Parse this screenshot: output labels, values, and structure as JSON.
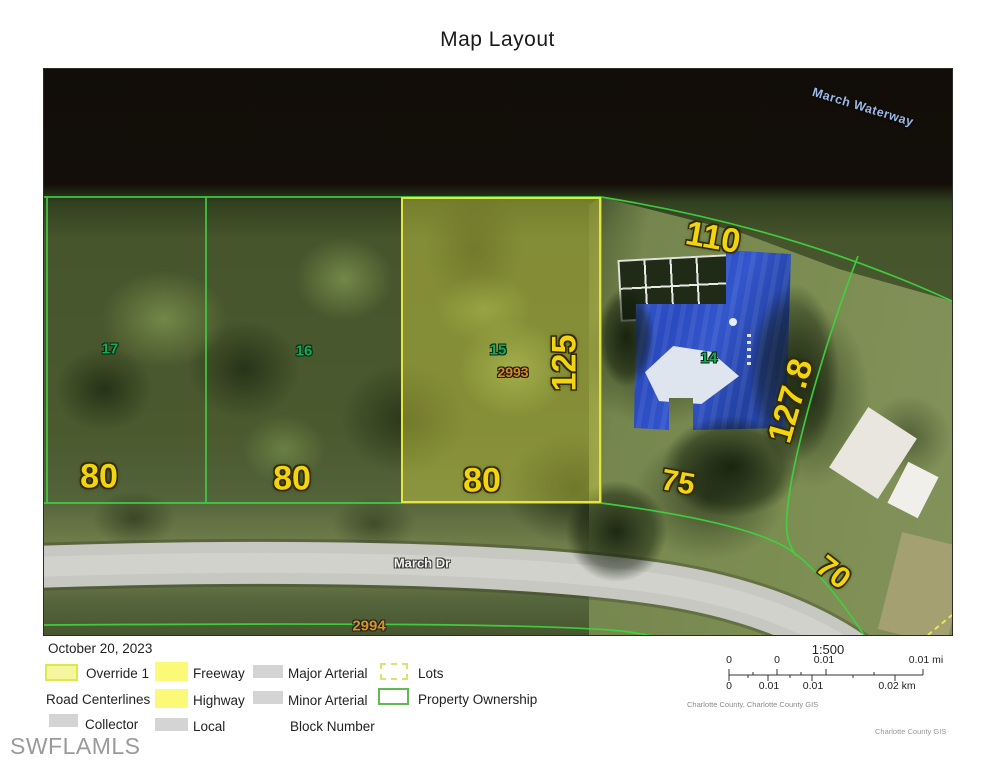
{
  "title": "Map Layout",
  "map": {
    "waterway": "March Waterway",
    "street": "March Dr",
    "lot17": "17",
    "lot16": "16",
    "lot15": "15",
    "lot14": "14",
    "parcel15_id": "2993",
    "block_line": "2994",
    "dim_80a": "80",
    "dim_80b": "80",
    "dim_80c": "80",
    "dim_125": "125",
    "dim_110": "110",
    "dim_127_8": "127.8",
    "dim_75": "75",
    "dim_70": "70"
  },
  "legend": {
    "date": "October 20, 2023",
    "override": "Override 1",
    "road_centerlines": "Road Centerlines",
    "collector": "Collector",
    "freeway": "Freeway",
    "highway": "Highway",
    "local": "Local",
    "major_arterial": "Major Arterial",
    "minor_arterial": "Minor Arterial",
    "block_number": "Block Number",
    "lots": "Lots",
    "property_ownership": "Property Ownership"
  },
  "scale": {
    "ratio": "1:500",
    "mi": [
      "0",
      "0",
      "0.01",
      "0.01 mi"
    ],
    "km": [
      "0",
      "0.01",
      "0.01",
      "0.02 km"
    ],
    "source": "Charlotte County, Charlotte County GIS"
  },
  "footer": {
    "watermark": "SWFLAMLS",
    "credit": "Charlotte County GIS"
  },
  "colors": {
    "parcel_line": "#3fd23f",
    "highlight": "#e6e640",
    "lot_number": "#16a85c",
    "dimension": "#f2d411",
    "parcel_id": "#d08a30",
    "waterway_label": "#9cb9e6",
    "roof_blue": "#2b4fc7"
  }
}
